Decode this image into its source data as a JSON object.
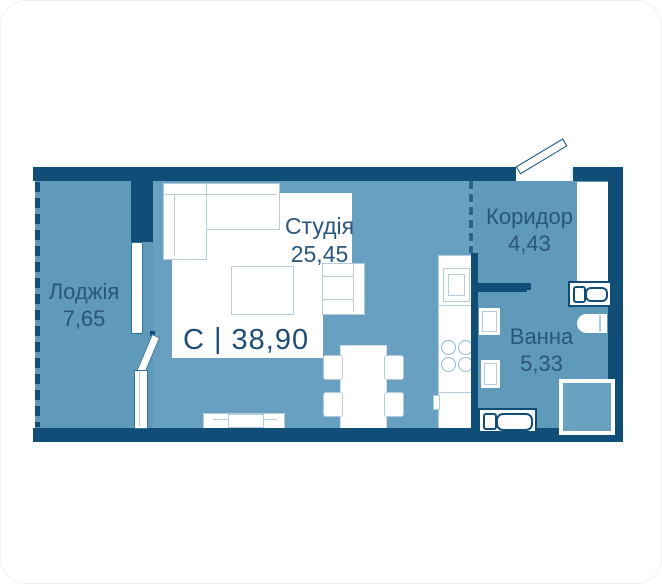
{
  "plan": {
    "total": {
      "code": "С",
      "divider": "|",
      "area": "38,90"
    },
    "rooms": {
      "studio": {
        "name": "Студія",
        "area": "25,45"
      },
      "loggia": {
        "name": "Лоджія",
        "area": "7,65"
      },
      "corridor": {
        "name": "Коридор",
        "area": "4,43"
      },
      "bathroom": {
        "name": "Ванна",
        "area": "5,33"
      }
    }
  },
  "colors": {
    "wall": "#104d77",
    "floor_studio": "#67a0c0",
    "floor_secondary": "#5f9aba",
    "furniture_outline": "#b5cadb",
    "label_text": "#2a567d",
    "background": "#ffffff"
  }
}
